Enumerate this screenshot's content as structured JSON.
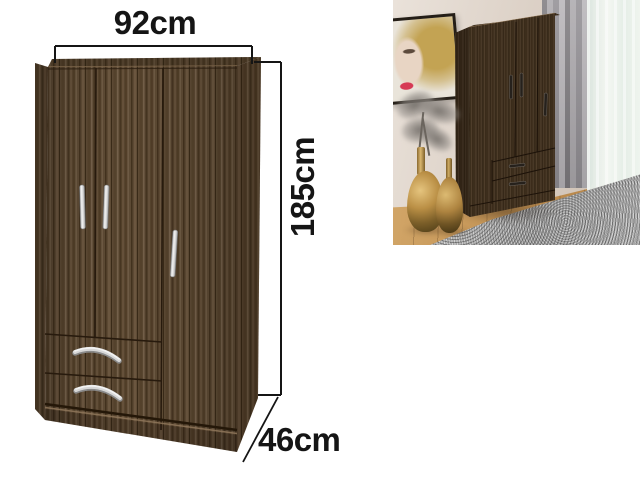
{
  "annotations": {
    "width_label": "92cm",
    "height_label": "185cm",
    "depth_label": "46cm",
    "text_color": "#151515",
    "line_color": "#151515"
  },
  "colors": {
    "wood": "#5b4832",
    "wood_dark": "#3f2f1d",
    "handle_silver": "#d9d9d9",
    "inset_wall": "#d9cdc2",
    "inset_floor": "#c2965c",
    "inset_rug": "#a6a6a6",
    "inset_curtain_gray": "#95929a",
    "inset_curtain_sheer": "#ecf4ee",
    "inset_vase_gold": "#b9904a",
    "inset_handle_dark": "#2a241e"
  }
}
